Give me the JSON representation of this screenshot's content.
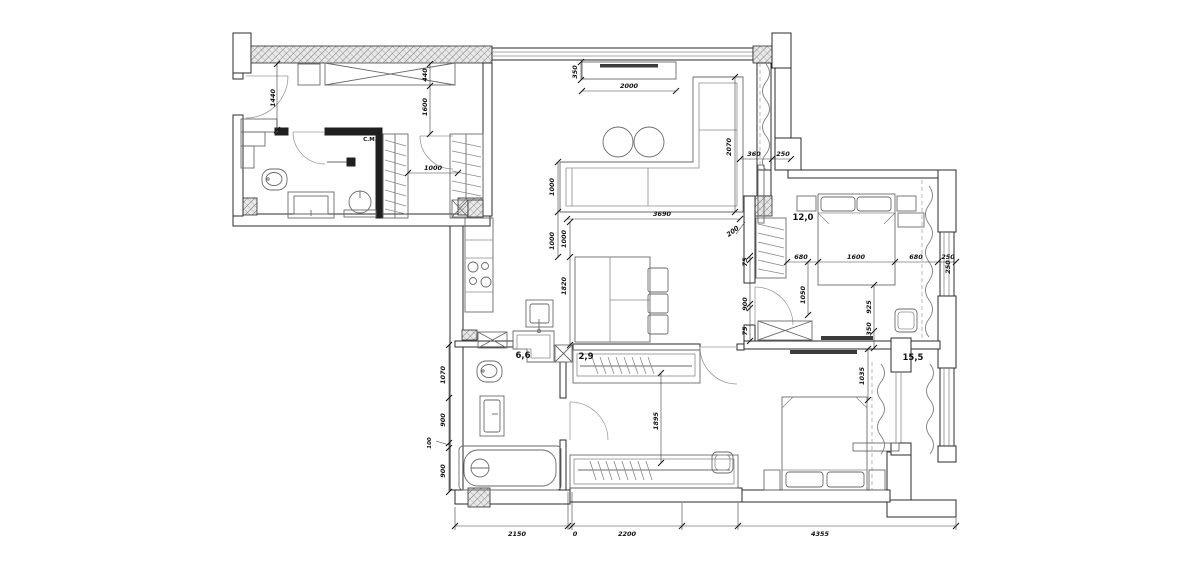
{
  "title": "Apartment floor plan with furniture and dimensions",
  "rooms": {
    "bedroom_small": "12,0",
    "bedroom_large": "15,5",
    "bathroom_main": "6,6",
    "wardrobe": "2,9",
    "washing_machine": "С.М."
  },
  "dims": {
    "entry_height": "1440",
    "entry_cabinet": "440",
    "entry_depth": "1600",
    "closet_gap": "1000",
    "tv_depth": "350",
    "tv_width": "2000",
    "sofa_depth": "1000",
    "sofa_gap": "1000",
    "sofa_width": "3690",
    "sofa_chaise": "2070",
    "pier_a": "360",
    "pier_b": "250",
    "wall_offset": "200",
    "kitchen_gap": "1000",
    "kitchen_run": "1820",
    "bed1_left": "680",
    "bed1_width": "1600",
    "bed1_right": "680",
    "bed1_pier": "250",
    "door_jamb_top": "75",
    "door_width": "900",
    "door_jamb_bottom": "75",
    "bed1_side": "1050",
    "bed1_foot": "925",
    "bed1_tv": "350",
    "window_right": "250",
    "hall_width": "1895",
    "bed2_head": "1035",
    "bath_wc": "1070",
    "bath_sink": "900",
    "bath_jog": "100",
    "bath_tub": "900",
    "total_bath": "2150",
    "total_zero": "0",
    "total_hall": "2200",
    "total_bedroom": "4355"
  }
}
